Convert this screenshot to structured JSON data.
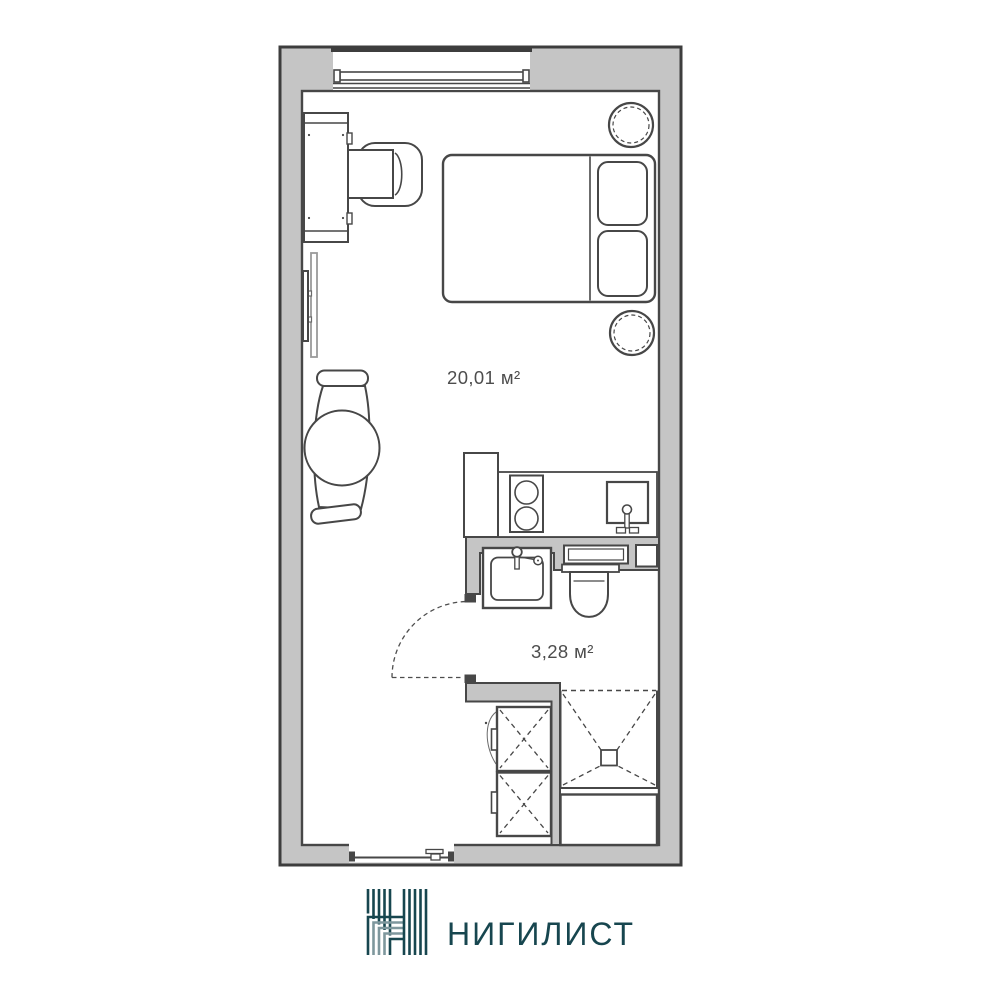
{
  "plan": {
    "rooms": {
      "main": {
        "area_label": "20,01 м²"
      },
      "bathroom": {
        "area_label": "3,28 м²"
      }
    },
    "colors": {
      "wall_fill": "#c5c5c5",
      "line": "#474747",
      "label_text": "#4d4d4d",
      "background": "#ffffff"
    },
    "furniture_symbols": [
      "window",
      "entrance-door",
      "double-bed",
      "pillow",
      "bedside-table",
      "desk",
      "desk-chair",
      "radiator",
      "armchair",
      "tall-cabinet",
      "kitchen-counter",
      "stove",
      "kitchen-sink",
      "bathroom-sink",
      "toilet",
      "cistern",
      "ventilation-shaft",
      "bathroom-door-swing",
      "shower",
      "washer-dryer-stack",
      "storage-cabinet"
    ]
  },
  "brand": {
    "name": "НИГИЛИСТ",
    "logo_primary": "#17464f",
    "logo_secondary": "#7e979d"
  }
}
